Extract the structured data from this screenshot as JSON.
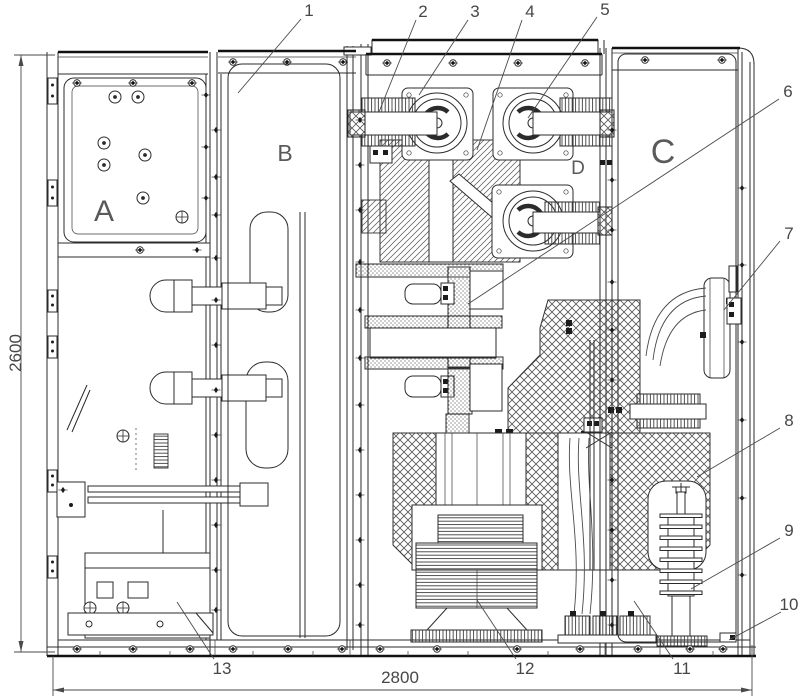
{
  "compartments": [
    {
      "label": "A"
    },
    {
      "label": "B"
    },
    {
      "label": "C"
    },
    {
      "label": "D"
    }
  ],
  "callouts": [
    {
      "label": "1"
    },
    {
      "label": "2"
    },
    {
      "label": "3"
    },
    {
      "label": "4"
    },
    {
      "label": "5"
    },
    {
      "label": "6"
    },
    {
      "label": "7"
    },
    {
      "label": "8"
    },
    {
      "label": "9"
    },
    {
      "label": "10"
    },
    {
      "label": "11"
    },
    {
      "label": "12"
    },
    {
      "label": "13"
    }
  ],
  "dimensions": {
    "overall_height_mm": "2600",
    "overall_width_mm": "2800"
  }
}
